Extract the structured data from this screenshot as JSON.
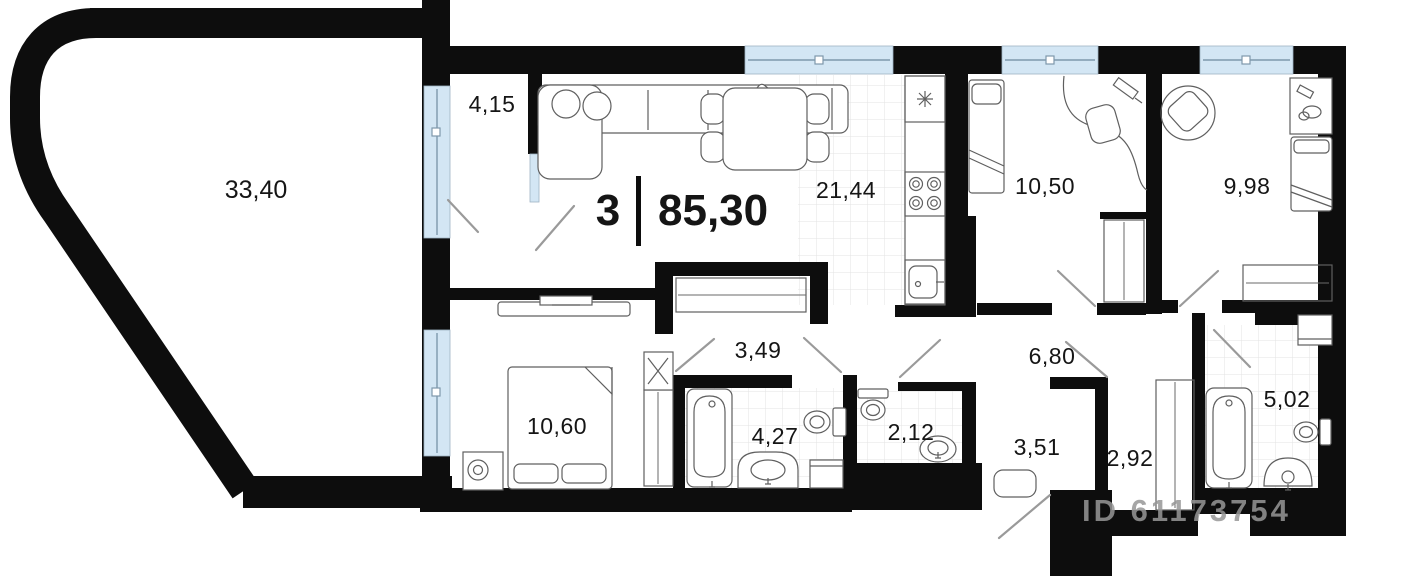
{
  "plan": {
    "type": "apartment-floor-plan",
    "summary": {
      "rooms_count": "3",
      "total_area": "85,30"
    },
    "watermark": "ID 61173754",
    "rooms": [
      {
        "name": "terrace",
        "area": "33,40"
      },
      {
        "name": "entry-hall",
        "area": "4,15"
      },
      {
        "name": "kitchen-living",
        "area": "21,44"
      },
      {
        "name": "bedroom-1",
        "area": "10,50"
      },
      {
        "name": "bedroom-2",
        "area": "9,98"
      },
      {
        "name": "corridor-1",
        "area": "3,49"
      },
      {
        "name": "corridor-2",
        "area": "6,80"
      },
      {
        "name": "bedroom-3",
        "area": "10,60"
      },
      {
        "name": "bathroom-1",
        "area": "4,27"
      },
      {
        "name": "wc",
        "area": "2,12"
      },
      {
        "name": "hallway",
        "area": "3,51"
      },
      {
        "name": "wardrobe",
        "area": "2,92"
      },
      {
        "name": "bathroom-2",
        "area": "5,02"
      }
    ],
    "colors": {
      "wall": "#0d0d0d",
      "window_glass": "#d3e6f4",
      "tile_line": "#e3e3e3",
      "furniture_line": "#5f5f5f",
      "watermark": "#979797",
      "background": "#ffffff"
    }
  }
}
